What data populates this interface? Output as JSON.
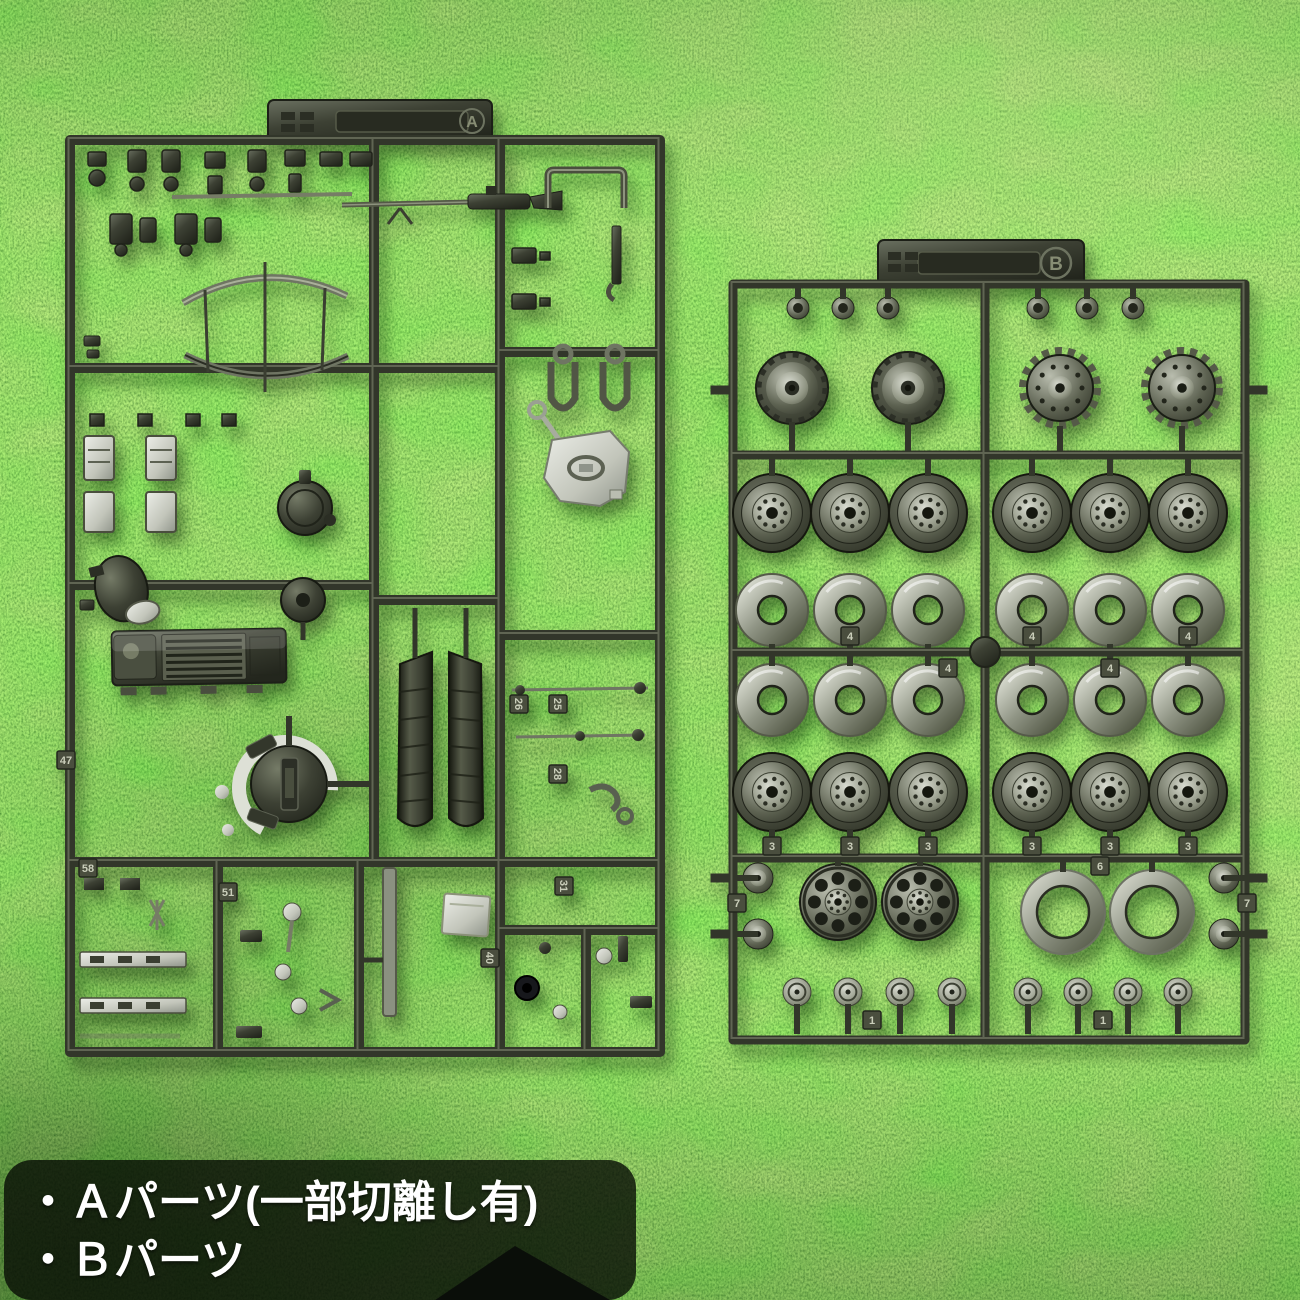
{
  "scene": {
    "description": "Two olive-drab plastic model kit runners (sprue A and sprue B with wheels) laid on bright green artificial turf, product photo with Japanese caption",
    "background": "artificial-grass-turf"
  },
  "caption": {
    "line1": "・Ａパーツ(一部切離し有)",
    "line2": "・Ｂパーツ",
    "text_color": "#ffffff",
    "panel_color": "rgba(7,13,5,0.80)"
  },
  "colors": {
    "grass_light": "#8fd45e",
    "grass_mid": "#4ea733",
    "grass_dark": "#2c631c",
    "plastic_base": "#3d4134",
    "plastic_highlight": "#9aa08c",
    "plastic_shadow": "#23261d",
    "bare_silver": "#d4d7cc",
    "fabric_dark": "#14161a"
  },
  "sprue_a": {
    "label": "A",
    "part_tags": [
      {
        "label": "58",
        "x": 88,
        "y": 868,
        "rot": 0
      },
      {
        "label": "51",
        "x": 228,
        "y": 892,
        "rot": 0
      },
      {
        "label": "26",
        "x": 519,
        "y": 704,
        "rot": 90
      },
      {
        "label": "25",
        "x": 558,
        "y": 704,
        "rot": 90
      },
      {
        "label": "28",
        "x": 558,
        "y": 774,
        "rot": 90
      },
      {
        "label": "31",
        "x": 564,
        "y": 886,
        "rot": 90
      },
      {
        "label": "40",
        "x": 490,
        "y": 958,
        "rot": 90
      },
      {
        "label": "47",
        "x": 66,
        "y": 760,
        "rot": 0
      }
    ]
  },
  "sprue_b": {
    "label": "B",
    "wheel_rows": [
      {
        "kind": "cap",
        "y": 308,
        "r": 11,
        "xs": [
          798,
          843,
          888,
          1038,
          1087,
          1133
        ],
        "stub": "up",
        "stub_to": 287,
        "tags": []
      },
      {
        "kind": "sprocket_inner",
        "y": 388,
        "r": 36,
        "xs": [
          792,
          908
        ],
        "stub": "down",
        "stub_to": 451,
        "tags": []
      },
      {
        "kind": "sprocket_outer",
        "y": 388,
        "r": 40,
        "xs": [
          1060,
          1182
        ],
        "stub": "down",
        "stub_to": 451,
        "tags": []
      },
      {
        "kind": "roadwheel",
        "y": 513,
        "r": 39,
        "xs": [
          772,
          850,
          928,
          1032,
          1110,
          1188
        ],
        "stub": "up",
        "stub_to": 459,
        "tags": []
      },
      {
        "kind": "dish",
        "y": 610,
        "r": 36,
        "hole": 14,
        "xs": [
          772,
          850,
          928,
          1032,
          1110,
          1188
        ],
        "stub": "down",
        "stub_to": 648,
        "tags": [
          {
            "x": 850,
            "y": 636,
            "label": "4"
          },
          {
            "x": 1032,
            "y": 636,
            "label": "4"
          },
          {
            "x": 1188,
            "y": 636,
            "label": "4"
          },
          {
            "x": 948,
            "y": 668,
            "label": "4"
          },
          {
            "x": 1110,
            "y": 668,
            "label": "4"
          }
        ]
      },
      {
        "kind": "dish",
        "y": 700,
        "r": 36,
        "hole": 14,
        "xs": [
          772,
          850,
          928,
          1032,
          1110,
          1188
        ],
        "stub": "up",
        "stub_to": 656,
        "tags": []
      },
      {
        "kind": "roadwheel",
        "y": 792,
        "r": 39,
        "xs": [
          772,
          850,
          928,
          1032,
          1110,
          1188
        ],
        "stub": "down",
        "stub_to": 854,
        "tags": [
          {
            "x": 772,
            "y": 846,
            "label": "3"
          },
          {
            "x": 850,
            "y": 846,
            "label": "3"
          },
          {
            "x": 928,
            "y": 846,
            "label": "3"
          },
          {
            "x": 1032,
            "y": 846,
            "label": "3"
          },
          {
            "x": 1110,
            "y": 846,
            "label": "3"
          },
          {
            "x": 1188,
            "y": 846,
            "label": "3"
          }
        ]
      },
      {
        "kind": "spoked",
        "y": 902,
        "r": 38,
        "xs": [
          838,
          920
        ],
        "stub": "up",
        "stub_to": 862,
        "tags": []
      },
      {
        "kind": "bigring",
        "y": 912,
        "r": 42,
        "hole": 26,
        "xs": [
          1063,
          1152
        ],
        "stub": "up",
        "stub_to": 862,
        "tags": [
          {
            "x": 1100,
            "y": 866,
            "label": "6"
          }
        ]
      },
      {
        "kind": "smallwheel",
        "y": 878,
        "r": 15,
        "xs": [
          758,
          1224
        ],
        "stub": "side",
        "stub_to": 0,
        "tags": [
          {
            "x": 737,
            "y": 903,
            "label": "7"
          },
          {
            "x": 1247,
            "y": 903,
            "label": "7"
          }
        ]
      },
      {
        "kind": "smallwheel",
        "y": 934,
        "r": 15,
        "xs": [
          758,
          1224
        ],
        "stub": "side",
        "stub_to": 0,
        "tags": []
      },
      {
        "kind": "hubcap",
        "y": 992,
        "r": 14,
        "xs": [
          797,
          848,
          900,
          952,
          1028,
          1078,
          1128,
          1178
        ],
        "stub": "down",
        "stub_to": 1034,
        "tags": [
          {
            "x": 872,
            "y": 1020,
            "label": "1"
          },
          {
            "x": 1103,
            "y": 1020,
            "label": "1"
          }
        ]
      }
    ]
  }
}
